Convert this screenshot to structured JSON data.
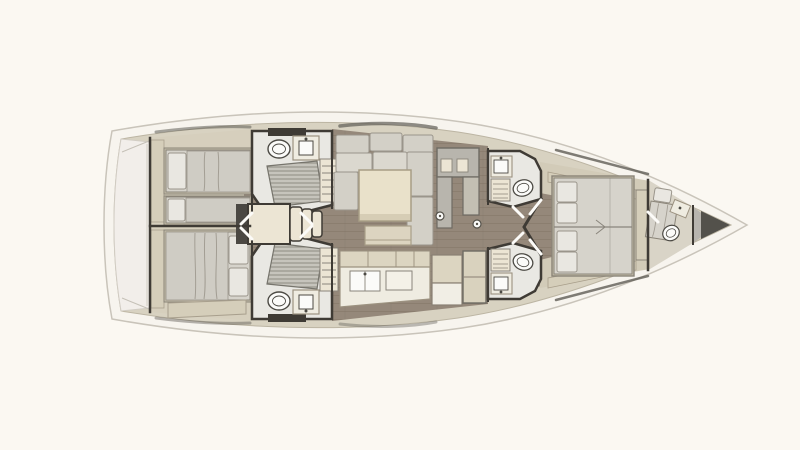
{
  "scene": {
    "description": "Top-down interior floor plan of a sailing yacht",
    "orientation": "bow-right",
    "style": "architectural render, no text labels"
  },
  "palette": {
    "background": "#fbf8f2",
    "hullFill": "#f7f4ee",
    "hullStroke": "#c9c4ba",
    "deck": "#d8d2c1",
    "deckLine": "#bcb5a3",
    "transom": "#f2eeea",
    "transomLine": "#d2cdc4",
    "wall": "#3f3b35",
    "cabinFloor": "#d6cfbd",
    "woodFloor": "#95887a",
    "woodLine": "#7d7061",
    "headFloor": "#e9e8e3",
    "ownerFloor": "#d2cbb8",
    "crewFloor": "#d9d4c7",
    "bedBase": "#c7bfab",
    "mattress": "#d6d3cb",
    "pillow": "#e9e7e1",
    "blanket": "#cfccc4",
    "cushion": "#d3d0c7",
    "cushionLight": "#dbd8cf",
    "tableCream": "#e9e1ca",
    "tableStroke": "#a79d85",
    "coffeeTable": "#dcd4c0",
    "counter": "#efece1",
    "counterStroke": "#9c9280",
    "cabinetTan": "#dcd5c1",
    "cabinetSeam": "#998f7e",
    "grayUnit": "#b8b5ad",
    "stepCream": "#ece5d4",
    "grate": "#c6c4bc",
    "grateLine": "#87857c",
    "fixtureWhite": "#fbfbf9",
    "fixtureStroke": "#4c4a44",
    "dark": "#4b4843",
    "anchorDark": "#53514b",
    "anchorLight": "#b7b4ae",
    "windowLine": "#5f5c55",
    "doorLeaf": "#fcfbf8",
    "furnStroke": "#8a8478",
    "benchTan": "#d5ceba"
  },
  "rooms": [
    {
      "id": "transom-garage",
      "label": "Transom / swim platform"
    },
    {
      "id": "aft-cabin-port",
      "label": "Aft cabin (top) with twin single berths",
      "fixtures": [
        "single berth",
        "single berth",
        "lockers"
      ]
    },
    {
      "id": "aft-cabin-starboard",
      "label": "Aft cabin (bottom) with double berth",
      "fixtures": [
        "double berth",
        "bench"
      ]
    },
    {
      "id": "aft-head-port",
      "label": "Aft head (top)",
      "fixtures": [
        "toilet",
        "sink",
        "shower grate",
        "shelf unit",
        "overhead hatch"
      ]
    },
    {
      "id": "aft-head-starboard",
      "label": "Aft head (bottom)",
      "fixtures": [
        "toilet",
        "sink",
        "shower grate",
        "shelf unit",
        "overhead hatch"
      ]
    },
    {
      "id": "companionway",
      "label": "Companionway platform and steps",
      "fixtures": [
        "platform",
        "three steps",
        "engine access"
      ]
    },
    {
      "id": "saloon",
      "label": "Saloon",
      "fixtures": [
        "U-shaped sofa",
        "dining table",
        "coffee table",
        "chaise",
        "utility unit"
      ]
    },
    {
      "id": "galley",
      "label": "Galley (bottom)",
      "fixtures": [
        "upper cabinets",
        "counter",
        "sink",
        "appliance block",
        "tall locker"
      ]
    },
    {
      "id": "forward-head-port",
      "label": "Forward head (top)",
      "fixtures": [
        "toilet",
        "sink",
        "shelf unit"
      ]
    },
    {
      "id": "forward-head-starboard",
      "label": "Forward head (bottom)",
      "fixtures": [
        "toilet",
        "sink",
        "shelf unit"
      ]
    },
    {
      "id": "owner-cabin",
      "label": "Forward owner cabin",
      "fixtures": [
        "island double berth",
        "four pillows",
        "side benches",
        "footboard"
      ]
    },
    {
      "id": "crew-cabin",
      "label": "Bow crew cabin",
      "fixtures": [
        "single berth",
        "toilet",
        "sink"
      ]
    },
    {
      "id": "anchor-locker",
      "label": "Anchor locker at bow"
    }
  ]
}
